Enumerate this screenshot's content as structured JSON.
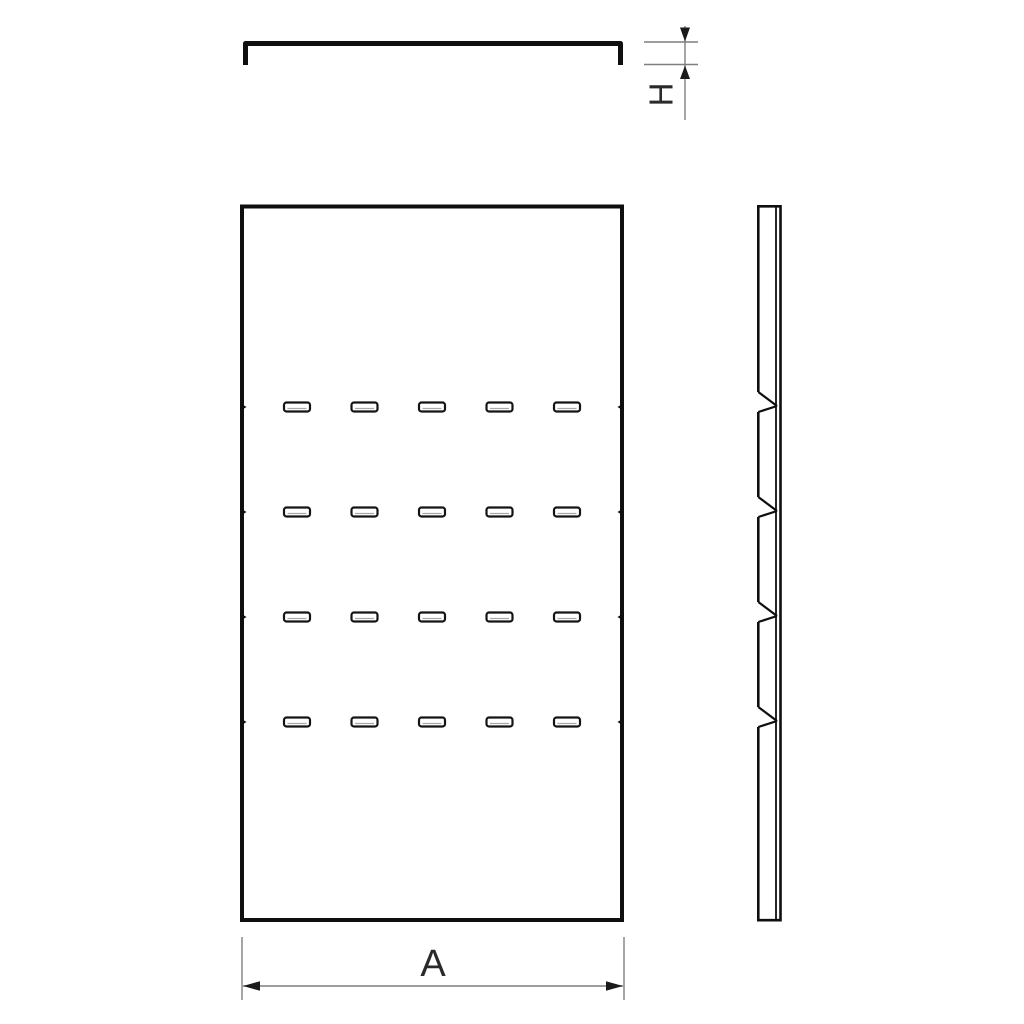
{
  "page": {
    "background": "#ffffff"
  },
  "labels": {
    "width_dimension": "A",
    "height_dimension": "H"
  },
  "front_view": {
    "slot_rows": 4,
    "slot_cols": 5
  },
  "side_view": {
    "notch_count": 4
  },
  "colors": {
    "part_outline": "#0f0f0f",
    "slot_outline": "#141414",
    "dimension_line": "#7f7f7f",
    "arrowhead": "#1a1a1a",
    "label_text": "#2a2a2a"
  }
}
